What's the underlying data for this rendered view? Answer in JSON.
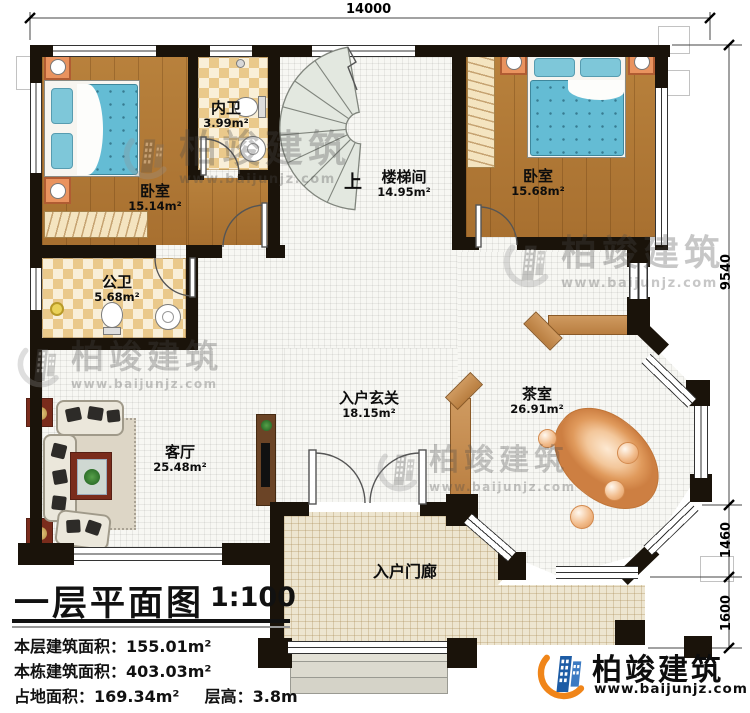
{
  "dims": {
    "top_width": "14000",
    "right_upper": "9540",
    "right_mid": "1460",
    "right_lower": "1600"
  },
  "rooms": {
    "bedroom1": {
      "label": "卧室",
      "area": "15.14m²"
    },
    "inner_bath": {
      "label": "内卫",
      "area": "3.99m²"
    },
    "stairwell": {
      "label": "楼梯间",
      "area": "14.95m²",
      "up": "上"
    },
    "bedroom2": {
      "label": "卧室",
      "area": "15.68m²"
    },
    "public_bath": {
      "label": "公卫",
      "area": "5.68m²"
    },
    "living_room": {
      "label": "客厅",
      "area": "25.48m²"
    },
    "entry_hall": {
      "label": "入户玄关",
      "area": "18.15m²"
    },
    "tea_room": {
      "label": "茶室",
      "area": "26.91m²"
    },
    "porch": {
      "label": "入户门廊"
    }
  },
  "title_block": {
    "title": "一层平面图",
    "scale": "1:100",
    "stats": [
      {
        "label": "本层建筑面积：",
        "value": "155.01m²"
      },
      {
        "label": "本栋建筑面积：",
        "value": "403.03m²"
      },
      {
        "label": "占地面积：",
        "value": "169.34m²"
      },
      {
        "label": "层高：",
        "value": "3.8m"
      }
    ]
  },
  "brand": {
    "name": "柏竣建筑",
    "url": "www.baijunjz.com"
  },
  "watermark": {
    "name": "柏竣建筑",
    "url": "www.baijunjz.com"
  },
  "colors": {
    "wall": "#1a130a",
    "wood_floor": "#b1793a",
    "tile_checker": "#eac98b",
    "grid_floor": "#f7f7f3",
    "porch_floor": "#ede5d0",
    "bed_blue": "#6fc2d8",
    "screen_wood": "#c08850",
    "stone": "#eeb184",
    "brand_blue": "#1d5ca5",
    "brand_orange": "#f08519"
  }
}
